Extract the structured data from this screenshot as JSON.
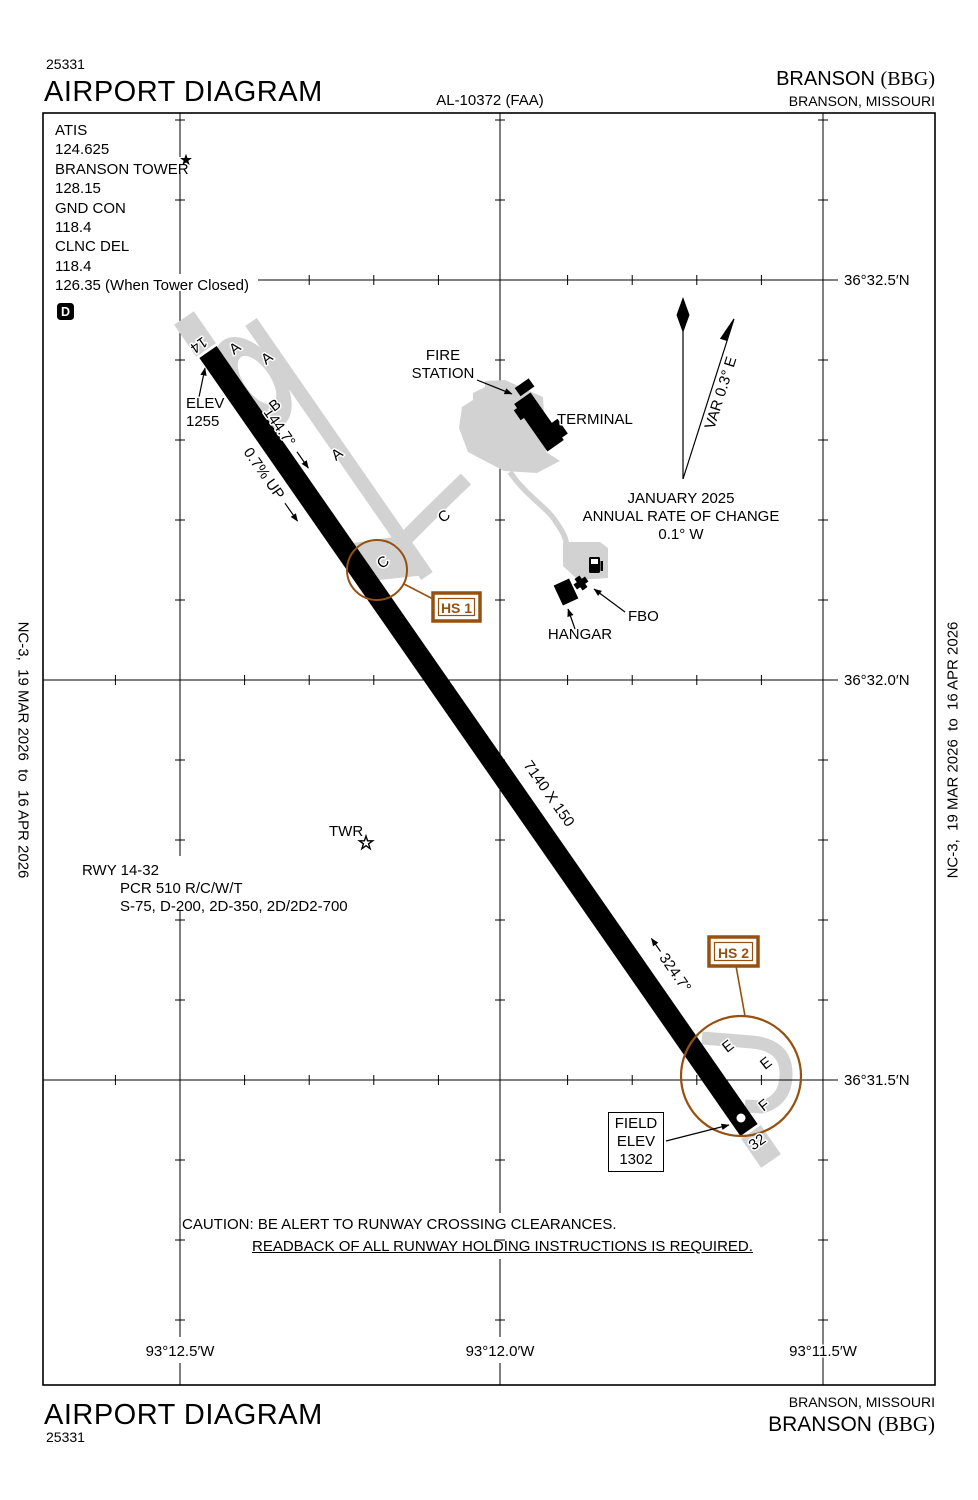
{
  "header": {
    "chart_number": "25331",
    "title": "AIRPORT DIAGRAM",
    "al_number": "AL-10372 (FAA)",
    "airport_name": "BRANSON",
    "airport_ident": "(BBG)",
    "city_state": "BRANSON, MISSOURI"
  },
  "footer": {
    "title": "AIRPORT DIAGRAM",
    "chart_number": "25331",
    "airport_name": "BRANSON",
    "airport_ident": "(BBG)",
    "city_state": "BRANSON, MISSOURI"
  },
  "margins": {
    "left_edition": "NC-3,  19 MAR 2026  to  16 APR 2026",
    "right_edition": "NC-3,  19 MAR 2026  to  16 APR 2026"
  },
  "frequencies": {
    "lines": [
      "ATIS",
      "124.625",
      "BRANSON TOWER",
      "128.15",
      "GND CON",
      "118.4",
      "CLNC DEL",
      "118.4",
      "126.35 (When Tower Closed)"
    ],
    "d_box": "D"
  },
  "grid": {
    "lat_labels": [
      "36°32.5′N",
      "36°32.0′N",
      "36°31.5′N"
    ],
    "lon_labels": [
      "93°12.5′W",
      "93°12.0′W",
      "93°11.5′W"
    ]
  },
  "runway": {
    "num_14": "14",
    "num_32": "32",
    "size": "7140 X 150",
    "hdg_14": "144.7°",
    "hdg_32": "324.7°",
    "gradient": "0.7% UP",
    "elev_14_line1": "ELEV",
    "elev_14_line2": "1255",
    "field_elev": [
      "FIELD",
      "ELEV",
      "1302"
    ],
    "info": [
      "RWY 14-32",
      "PCR 510 R/C/W/T",
      "S-75, D-200, 2D-350, 2D/2D2-700"
    ]
  },
  "taxiways": {
    "a": "A",
    "b": "B",
    "c": "C",
    "e": "E",
    "f": "F"
  },
  "facilities": {
    "fire_station_line1": "FIRE",
    "fire_station_line2": "STATION",
    "terminal": "TERMINAL",
    "hangar": "HANGAR",
    "fbo": "FBO",
    "tower": "TWR"
  },
  "variation": {
    "label": "VAR 0.3° E",
    "date": "JANUARY 2025",
    "rate_line1": "ANNUAL RATE OF CHANGE",
    "rate_line2": "0.1° W"
  },
  "hotspots": {
    "hs1": "HS 1",
    "hs2": "HS 2"
  },
  "caution": {
    "line1": "CAUTION: BE ALERT TO RUNWAY CROSSING CLEARANCES.",
    "line2": "READBACK OF ALL RUNWAY HOLDING INSTRUCTIONS IS REQUIRED."
  },
  "icons": {
    "tower_location": "open-star",
    "tower_frequency_flag": "solid-star",
    "fuel": "fuel-pump"
  },
  "colors": {
    "taxiway": "#d2d2d2",
    "hotspot": "#96500f",
    "ink": "#000000"
  }
}
